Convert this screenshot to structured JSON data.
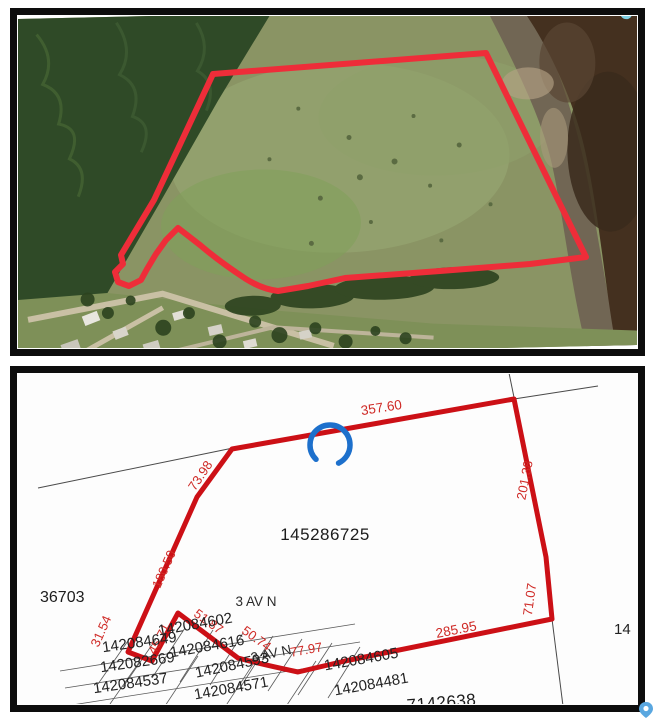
{
  "top_panel": {
    "type": "aerial-photo",
    "colors": {
      "frame": "#0d0d0d",
      "forest": "#2f4a27",
      "field": "#8a9464",
      "meadow": "#95a571",
      "lawn": "#7e9058",
      "mudflat": "#6e6152",
      "water": "#44301f",
      "water_dark": "#392a1c",
      "road": "#c9c0a4",
      "pond_cyan": "#7fd0e4",
      "boundary_red": "#ee2d39"
    }
  },
  "plat_panel": {
    "type": "plat-map",
    "colors": {
      "frame": "#0d0d0d",
      "background": "#fdfdfd",
      "boundary_red": "#cc1016",
      "dimension_red": "#cf2b27",
      "parcel_text": "#1c1c1c",
      "survey_line": "#4a4a4a",
      "marker_blue": "#1d70cc"
    },
    "main_parcel": "145286725",
    "left_parcel": "36703",
    "street1": "3 AV N",
    "street2": "3 AV N",
    "dims": {
      "top": "357.60",
      "upper_left": "73.98",
      "left": "180.50",
      "right_upper": "201.38",
      "right_lower": "71.07",
      "bottom": "285.95",
      "d31": "31.54",
      "d45": "45.71",
      "d51": "51.87",
      "d50": "50.74",
      "d77": "77.97"
    },
    "parcels": {
      "p649": "142084649",
      "p602": "142084602",
      "p616": "142084616",
      "p593": "142084593",
      "p669": "142082669",
      "p537": "142084537",
      "p571": "142084571",
      "p605": "142084605",
      "p481": "142084481",
      "p638": "7142638",
      "p14": "14"
    }
  },
  "pin": {
    "color": "#5aa7e0"
  }
}
